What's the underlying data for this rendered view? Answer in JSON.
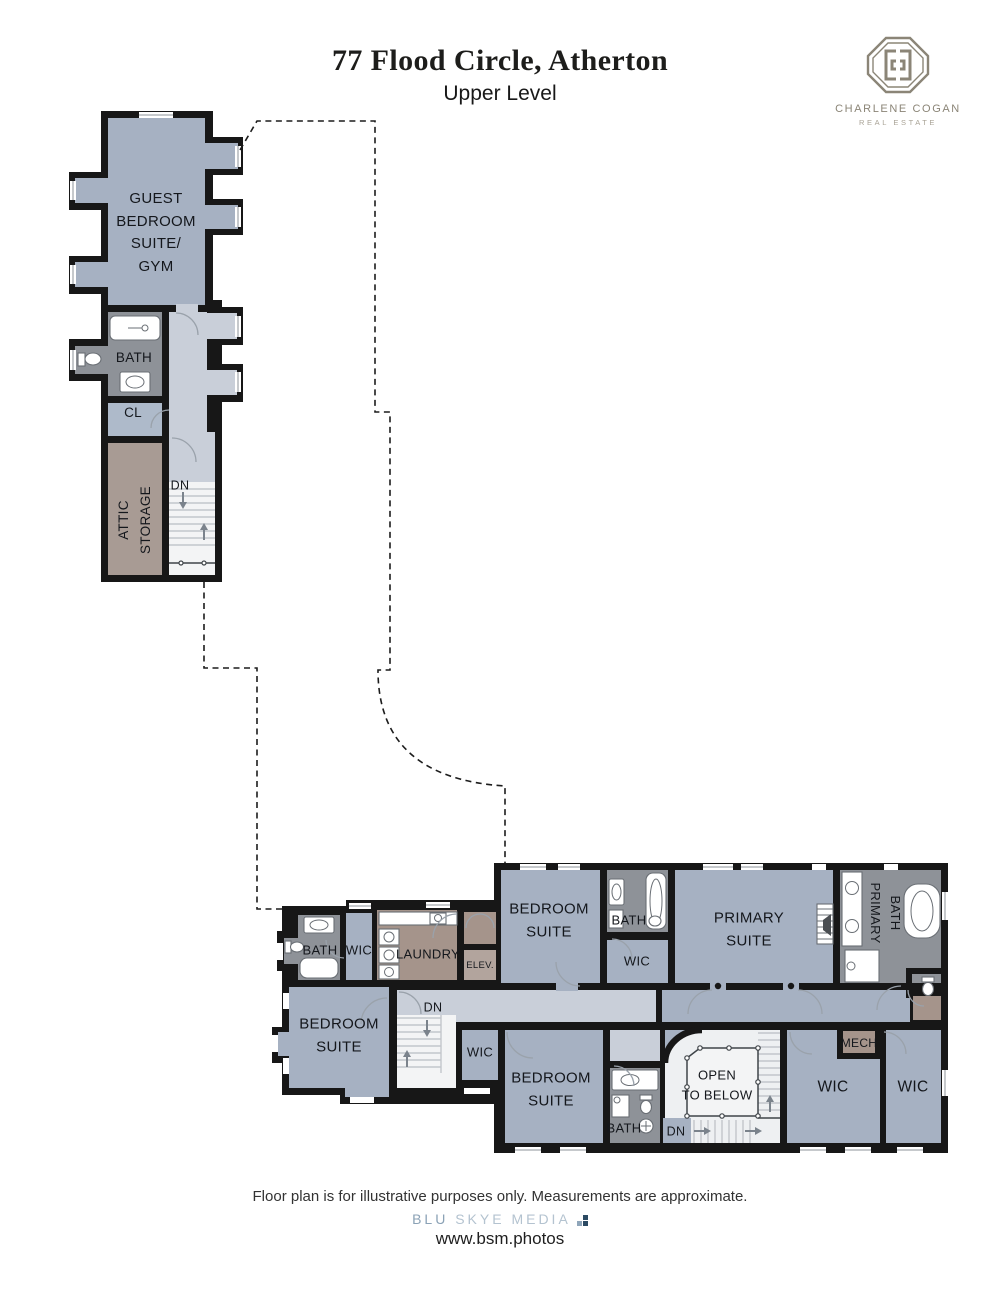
{
  "header": {
    "title": "77 Flood Circle, Atherton",
    "subtitle": "Upper Level"
  },
  "brand": {
    "name": "CHARLENE COGAN",
    "tagline": "REAL ESTATE"
  },
  "palette": {
    "room_blue": "#a6b1c2",
    "hall_gray": "#c9cfd9",
    "bath_gray": "#8e9298",
    "storage_brown": "#a5948b",
    "attic_brown": "#a89b94",
    "wall_black": "#171717",
    "closet_blue": "#aebaca",
    "elev_gray": "#b2a49d"
  },
  "upper_wing": {
    "guest_suite": "GUEST\nBEDROOM\nSUITE/\nGYM",
    "bath": "BATH",
    "closet": "CL",
    "attic_line1": "ATTIC",
    "attic_line2": "STORAGE",
    "stairs_down": "DN"
  },
  "lower_wing": {
    "bath_left": "BATH",
    "wic_left": "WIC",
    "laundry": "LAUNDRY",
    "elevator": "ELEV.",
    "bedroom_top": "BEDROOM\nSUITE",
    "bath_top": "BATH",
    "wic_top": "WIC",
    "primary_suite": "PRIMARY\nSUITE",
    "primary_bath_line1": "PRIMARY",
    "primary_bath_line2": "BATH",
    "bedroom_left": "BEDROOM\nSUITE",
    "stairs_down_left": "DN",
    "wic_small": "WIC",
    "bedroom_bottom": "BEDROOM\nSUITE",
    "bath_bottom": "BATH",
    "open_to_below": "OPEN\nTO BELOW",
    "stairs_down_bottom": "DN",
    "mech": "MECH",
    "wic_bottom_left": "WIC",
    "wic_bottom_right": "WIC"
  },
  "footer": {
    "disclaimer": "Floor plan is for illustrative purposes only. Measurements are approximate.",
    "credit_brand_primary": "BLU",
    "credit_brand_secondary": "SKYE MEDIA",
    "credit_url": "www.bsm.photos"
  }
}
